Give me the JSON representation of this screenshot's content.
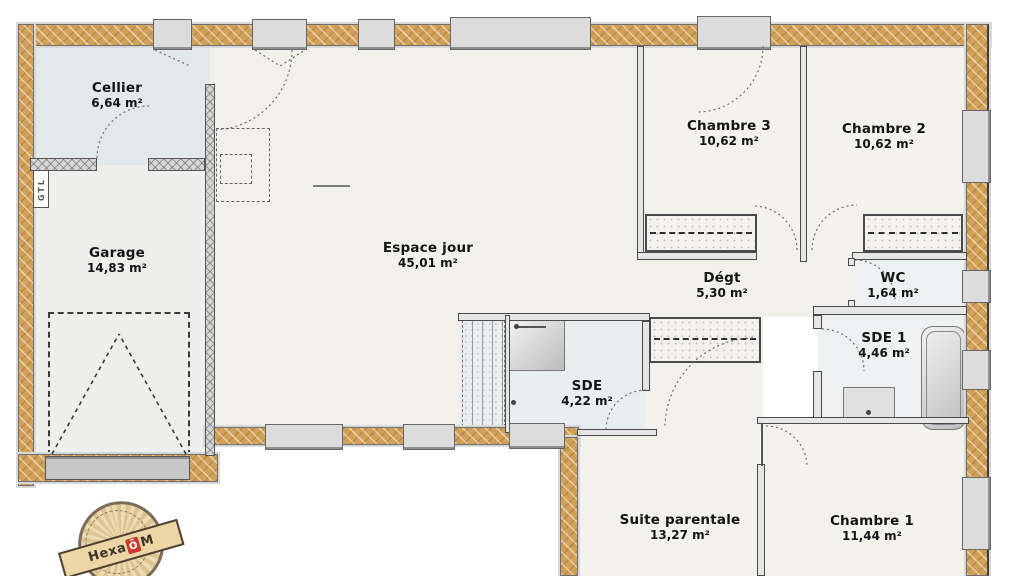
{
  "plan_title": "single-storey house floor plan",
  "rooms": [
    {
      "id": "cellier",
      "name": "Cellier",
      "area": "6,64 m²"
    },
    {
      "id": "garage",
      "name": "Garage",
      "area": "14,83 m²"
    },
    {
      "id": "espace-jour",
      "name": "Espace jour",
      "area": "45,01 m²"
    },
    {
      "id": "chambre-3",
      "name": "Chambre 3",
      "area": "10,62 m²"
    },
    {
      "id": "chambre-2",
      "name": "Chambre 2",
      "area": "10,62 m²"
    },
    {
      "id": "degt",
      "name": "Dégt",
      "area": "5,30 m²"
    },
    {
      "id": "wc",
      "name": "WC",
      "area": "1,64 m²"
    },
    {
      "id": "sde-1",
      "name": "SDE 1",
      "area": "4,46 m²"
    },
    {
      "id": "sde",
      "name": "SDE",
      "area": "4,22 m²"
    },
    {
      "id": "suite-parentale",
      "name": "Suite parentale",
      "area": "13,27 m²"
    },
    {
      "id": "chambre-1",
      "name": "Chambre 1",
      "area": "11,44 m²"
    }
  ],
  "annotations": {
    "gtl": "GTL"
  },
  "stamp": {
    "brand_prefix": "Hexa",
    "brand_accent": "ō",
    "brand_suffix": "M"
  },
  "colors": {
    "wall_insulation": "#d2a057",
    "wall_gray": "#6f6f6f",
    "window_fill": "#dcdcdc",
    "floor_light": "#f1f0eb",
    "floor_wet": "#e9eef0",
    "floor_cellier": "#e3e9ea",
    "stamp_paper": "#ecd9b0",
    "stamp_red": "#cc352b",
    "text": "#141414"
  }
}
